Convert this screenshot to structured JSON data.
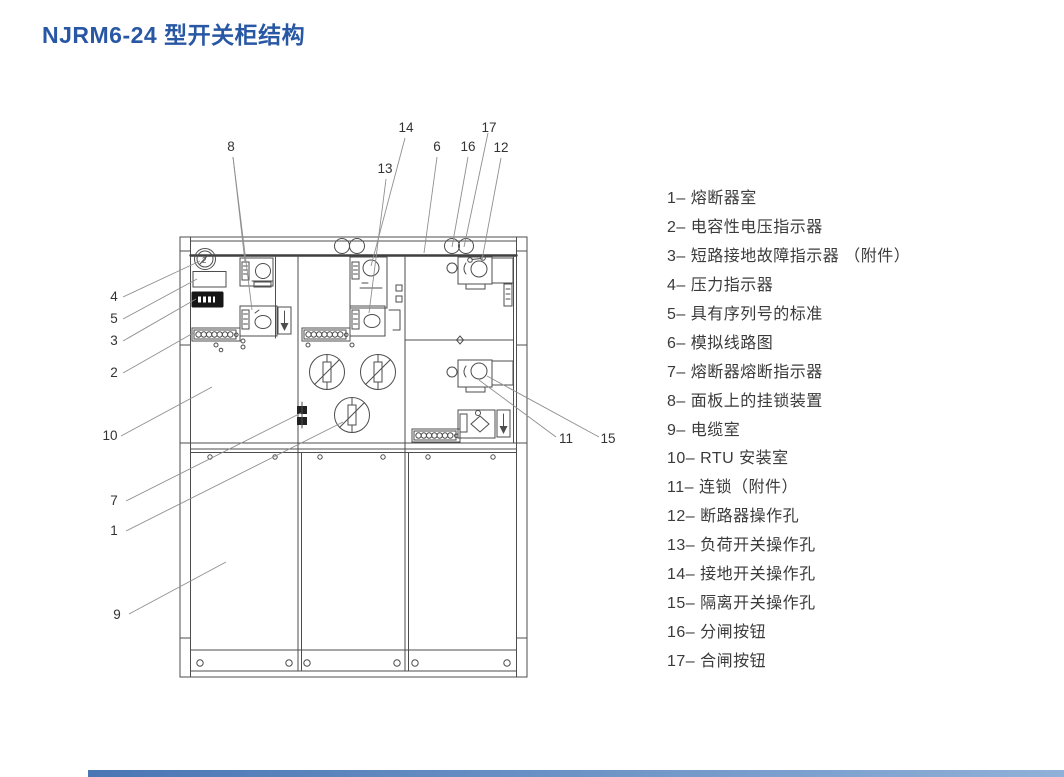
{
  "title": "NJRM6-24 型开关柜结构",
  "colors": {
    "title_blue": "#2857a4",
    "drawing_line": "#4d4d4d",
    "leader_line": "#8f8f8f",
    "legend_text": "#3b3b3b",
    "accent_bar": "#4a76b4"
  },
  "legend": {
    "items": [
      {
        "text": "1– 熔断器室"
      },
      {
        "text": "2– 电容性电压指示器"
      },
      {
        "text": "3– 短路接地故障指示器 （附件）"
      },
      {
        "text": "4– 压力指示器"
      },
      {
        "text": "5– 具有序列号的标准"
      },
      {
        "text": "6– 模拟线路图"
      },
      {
        "text": "7– 熔断器熔断指示器"
      },
      {
        "text": "8– 面板上的挂锁装置"
      },
      {
        "text": "9– 电缆室"
      },
      {
        "text": "10–  RTU 安装室"
      },
      {
        "text": "11– 连锁（附件）"
      },
      {
        "text": "12– 断路器操作孔"
      },
      {
        "text": "13– 负荷开关操作孔"
      },
      {
        "text": "14– 接地开关操作孔"
      },
      {
        "text": "15– 隔离开关操作孔"
      },
      {
        "text": "16– 分闸按钮"
      },
      {
        "text": "17– 合闸按钮"
      }
    ]
  },
  "drawing": {
    "gauge_digit": "2",
    "callouts": {
      "c8": "8",
      "c13": "13",
      "c14": "14",
      "c6": "6",
      "c16": "16",
      "c17": "17",
      "c12": "12",
      "c4": "4",
      "c5": "5",
      "c3": "3",
      "c2": "2",
      "c10": "10",
      "c7": "7",
      "c1": "1",
      "c9": "9",
      "c11": "11",
      "c15": "15"
    }
  }
}
